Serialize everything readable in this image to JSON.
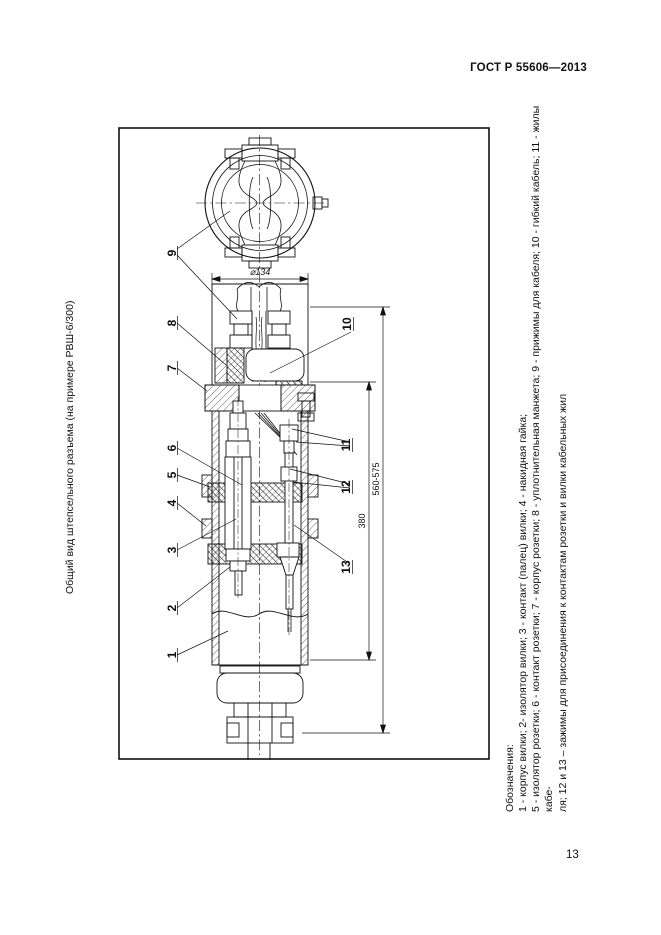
{
  "page": {
    "standard_code": "ГОСТ Р 55606—2013",
    "page_number": "13",
    "side_title": "Общий вид штепсельного разъема (на примере РВШ-6/300)"
  },
  "figure": {
    "legend_lines": [
      "Обозначения:",
      "1 - корпус вилки; 2- изолятор вилки; 3 - контакт (палец) вилки; 4 - накидная гайка;",
      "5 - изолятор розетки; 6 - контакт розетки; 7 - корпус розетки; 8 - уплотнительная манжета; 9 - прижимы для кабеля; 10 - гибкий кабель; 11 - жилы кабе-",
      "ля; 12 и 13 – зажимы для присоединения к контактам розетки и вилки кабельных жил"
    ],
    "callouts_left": [
      "9",
      "8",
      "7",
      "6",
      "5",
      "4",
      "3",
      "2",
      "1"
    ],
    "callouts_right": [
      "10",
      "11",
      "12",
      "13"
    ],
    "dimensions": {
      "diameter": "⌀134",
      "partial_length": "380",
      "overall_length": "560-575"
    }
  }
}
